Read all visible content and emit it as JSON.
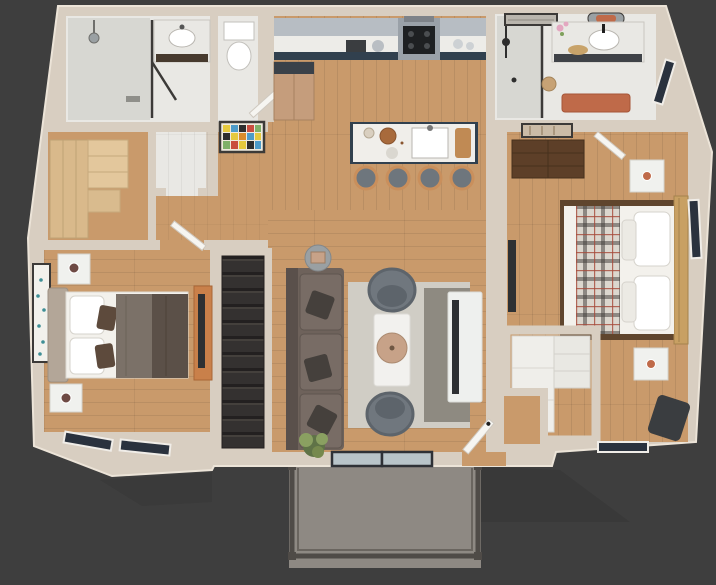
{
  "scene": {
    "kind": "3d-apartment-floor-plan-render",
    "background": "#3e3e3e",
    "visible_text": []
  },
  "palette": {
    "bg": "#3e3e3e",
    "wall": "#d8cec1",
    "wall_edge": "#ece4d8",
    "wall_shade": "#c2b7a9",
    "wood": "#c99a6b",
    "wood_dark": "#b9895b",
    "marble": "#e9e8e4",
    "tile": "#d7d7d2",
    "navy": "#31404e",
    "cab_gray": "#b7bdc3",
    "counter": "#edece8",
    "steel": "#9aa1a8",
    "cooktop": "#1e2022",
    "fridge": "#c59d7c",
    "fridge_dark": "#3a4149",
    "island_top": "#f0eeea",
    "stool_seat": "#6e767d",
    "stool_wood": "#c98f5c",
    "sofa": "#6e625b",
    "sofa_dark": "#5a504b",
    "pillow_dark": "#45403c",
    "chair": "#70777e",
    "chair_dark": "#5d646b",
    "rug_light": "#d0cdc5",
    "rug_dark": "#8e8a81",
    "table_white": "#f2f1ee",
    "tray": "#c7a288",
    "tv_dark": "#2d3033",
    "console": "#eef0ee",
    "stairs_base": "#343130",
    "tread_dark": "#232020",
    "tread_light": "#44403c",
    "balcony_floor": "#8e8983",
    "railing": "#4f4b47",
    "bed_white": "#f3f1ec",
    "headboard": "#b3a698",
    "duvet_gray": "#7b7168",
    "duvet_brown": "#5b5048",
    "plaid": "#dcd7ce",
    "plaid_line": "#3e3a36",
    "plaid_red": "#a64a3a",
    "bedframe": "#5f452d",
    "rattan": "#c8a063",
    "nightstand": "#f0f1ee",
    "dresser": "#5d3f28",
    "terracotta": "#bf6a49",
    "plant_dark": "#5f7347",
    "plant_light": "#8aa061",
    "door_white": "#f6f5f1",
    "window_dark": "#2a323e",
    "window_frame": "#f0ede8",
    "art_frame": "#3c3a38",
    "glass": "#b8c4c9",
    "mirror_gray": "#9aa0a3",
    "closet_wood": "#d9b98b",
    "shelf_white": "#efeeea",
    "shadow": "#262626"
  },
  "rooms": [
    {
      "id": "bathroom-main",
      "items": [
        "walk-in-shower",
        "shower-head",
        "glass-door",
        "vanity-sink",
        "water-closet",
        "toilet",
        "wc-door",
        "abstract-mosaic-art"
      ]
    },
    {
      "id": "walk-in-closet",
      "items": [
        "wardrobe",
        "shelving-unit",
        "linen-nook"
      ]
    },
    {
      "id": "hallway",
      "items": [
        "bedroom-door"
      ]
    },
    {
      "id": "kitchen",
      "items": [
        "upper-cabinets",
        "counter",
        "range-oven",
        "microwave-hood",
        "refrigerator",
        "toaster",
        "island",
        "island-sink",
        "cutting-board",
        "wood-bowl",
        "bar-stool",
        "bar-stool",
        "bar-stool",
        "bar-stool"
      ]
    },
    {
      "id": "living-room",
      "items": [
        "sofa",
        "throw-pillows",
        "round-mirror",
        "area-rug",
        "coffee-table",
        "decor-tray",
        "accent-chair",
        "accent-chair",
        "tv-console",
        "tv",
        "houseplant",
        "sliding-door",
        "entry-door"
      ]
    },
    {
      "id": "staircase",
      "items": [
        "stair-treads"
      ]
    },
    {
      "id": "bedroom-left",
      "items": [
        "bed",
        "upholstered-headboard",
        "pillows",
        "duvet",
        "nightstand",
        "nightstand",
        "teal-wall-art",
        "tv-stand",
        "tv",
        "window",
        "window"
      ]
    },
    {
      "id": "bedroom-right",
      "items": [
        "bed",
        "rattan-headboard",
        "plaid-blanket",
        "pillows",
        "nightstand",
        "nightstand",
        "dresser",
        "botanical-art",
        "tv",
        "closet-shelving",
        "lounge-chair",
        "window",
        "window",
        "entry-nook"
      ]
    },
    {
      "id": "bathroom-ensuite",
      "items": [
        "shower",
        "shower-set",
        "vanity-sink",
        "arch-mirror",
        "landscape-art",
        "orchid",
        "basket",
        "bath-rug",
        "window"
      ]
    },
    {
      "id": "balcony",
      "items": [
        "deck-floor",
        "railing",
        "corner-posts"
      ]
    }
  ]
}
